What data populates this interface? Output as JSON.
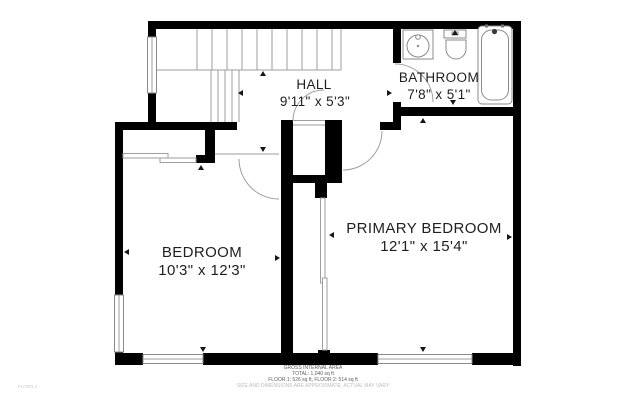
{
  "plan": {
    "rooms": [
      {
        "name": "HALL",
        "dims": "9'11\" x 5'3\""
      },
      {
        "name": "BATHROOM",
        "dims": "7'8\" x 5'1\""
      },
      {
        "name": "BEDROOM",
        "dims": "10'3\" x 12'3\""
      },
      {
        "name": "PRIMARY BEDROOM",
        "dims": "12'1\" x 15'4\""
      }
    ],
    "footer": {
      "title": "GROSS INTERNAL AREA",
      "total": "TOTAL: 1,040 sq ft",
      "floors": "FLOOR 1: 526 sq ft, FLOOR 2: 514 sq ft",
      "disclaimer": "SIZE AND DIMENSIONS ARE APPROXIMATE, ACTUAL MAY VARY"
    },
    "floor_label": "FLOOR 2",
    "colors": {
      "wall": "#000000",
      "line": "#9e9e9e",
      "text": "#1f1f1f",
      "footer_text": "#606060",
      "muted": "#bdbdbd"
    }
  }
}
